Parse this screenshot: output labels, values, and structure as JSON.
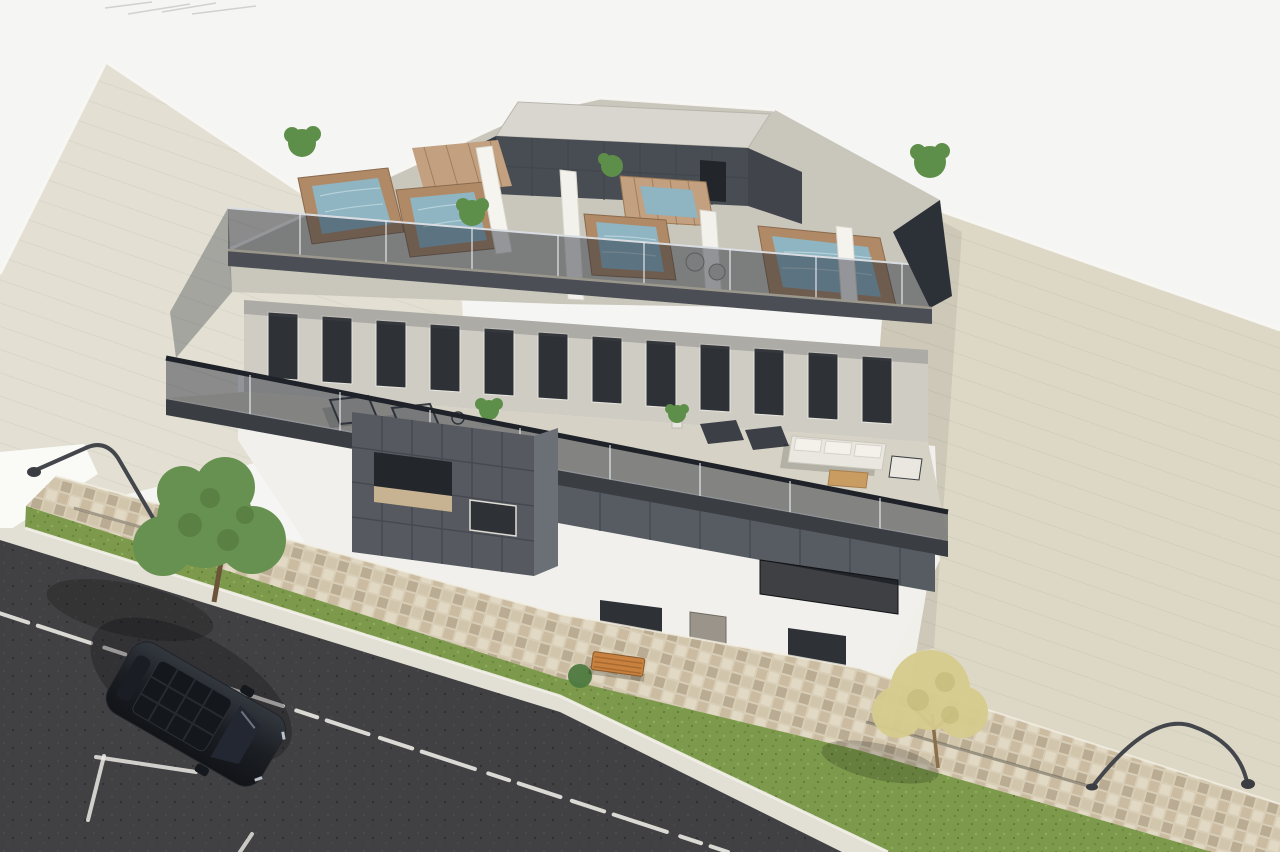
{
  "meta": {
    "title": "Aerial 3D architectural rendering of a modern apartment building",
    "type": "computer-generated exterior visualization",
    "view": "high-angle aerial three-quarter view",
    "lighting": "bright daylight, sun from upper right, shadows cast left"
  },
  "scene": {
    "main_building": {
      "label": "three-storey white and anthracite apartment block",
      "features": [
        "roof terrace with plunge pools with timber-clad surrounds",
        "frameless glass balustrades with dark caps",
        "dark tiled stair core with light flat roof",
        "upper-floor terrace with sun loungers, potted plants and white lounge sofa set with timber coffee table",
        "anthracite tile-grid facade band with recessed balcony openings",
        "white ground floor with dark-framed windows and balcony railings"
      ],
      "counts": {
        "rooftop_pools": 5,
        "terrace_pools": 2,
        "sun_loungers": 4,
        "potted_plants": 6,
        "outdoor_sofas": 1
      }
    },
    "neighbor_building": {
      "label": "adjacent building with beige flat roof and white street-facing wall"
    },
    "courtyard": {
      "label": "large beige paved area behind and beside the building"
    },
    "sidewalk": {
      "label": "landscaped street verge",
      "elements": [
        "mosaic paved walkway",
        "grass strip",
        "green leafy tree",
        "small yellow-leaved tree",
        "timber slat bench",
        "two curved dark street lamps",
        "low shrub"
      ]
    },
    "street": {
      "label": "asphalt road with white markings",
      "elements": [
        "white kerb line",
        "weathered dashed lane line",
        "parking bay lines",
        "parked dark grey car with panoramic glass roof"
      ]
    }
  },
  "objects": {
    "cars": 1,
    "trees": 2,
    "street_lamps": 2,
    "benches": 1
  },
  "palette": {
    "sky": "#f5f5f3",
    "neighbor_roof": "#e3e0d3",
    "neighbor_wall": "#fafaf7",
    "pavement": "#ddd8c6",
    "cobble": "#d8cdb6",
    "grass": "#7d9a4c",
    "kerb": "#e2dfd4",
    "asphalt": "#414143",
    "road_marking": "#eceae4",
    "roof_deck": "#c9c6bb",
    "dark_panel": "#565a60",
    "white_wall": "#f1f0ec",
    "pool_water": "#8fb4c2",
    "pool_surround": "#b08a66",
    "wood_deck": "#c3a080",
    "tree_green": "#679150",
    "tree_yellow": "#d6cc8d",
    "plant_green": "#5e8f4a",
    "bench_wood": "#c8813f",
    "lamp_metal": "#43464b",
    "car_body": "#202329",
    "sofa_cushion": "#e9e7e0"
  }
}
